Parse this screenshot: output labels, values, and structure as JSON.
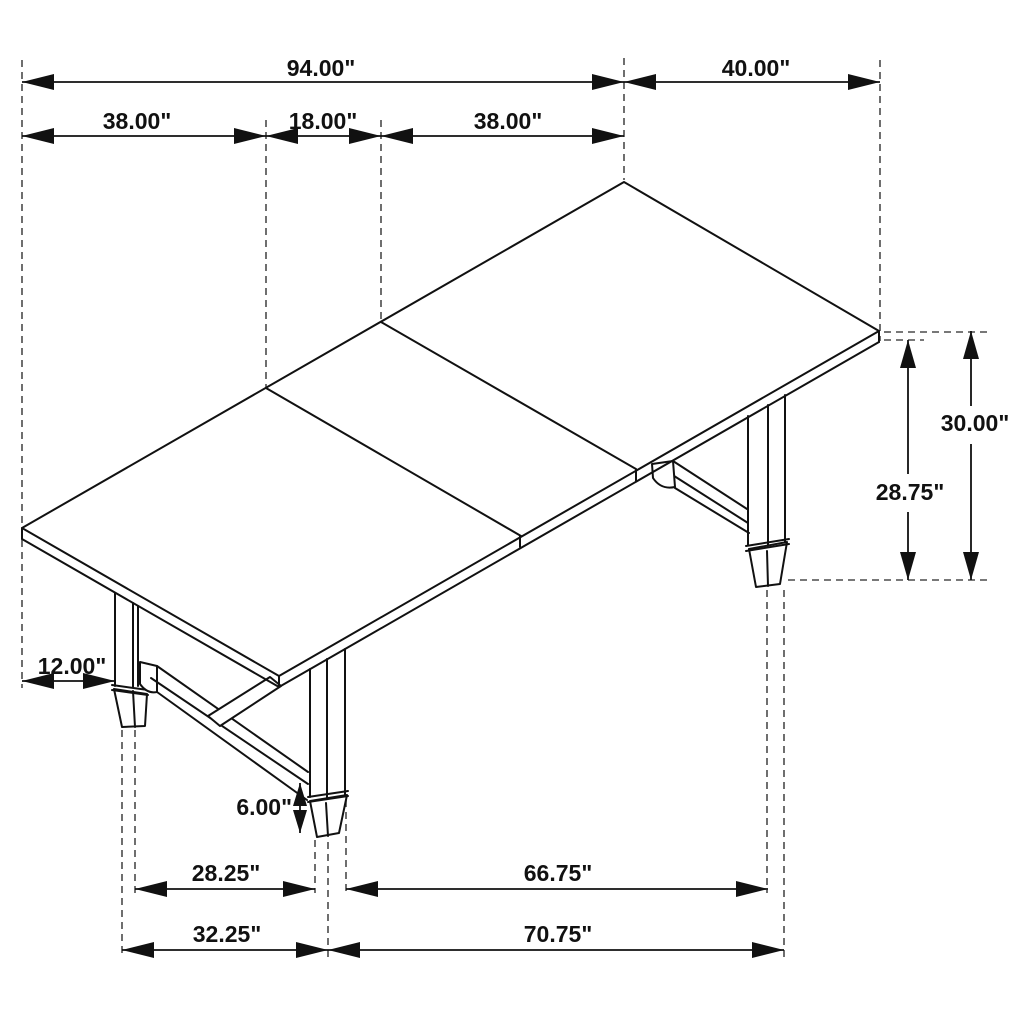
{
  "diagram": {
    "subject": "dining-table-dimension-drawing",
    "unit": "inches",
    "colors": {
      "background": "#ffffff",
      "drawing_line": "#111111",
      "extension_dash": "#4b4b4b",
      "text": "#111111"
    },
    "dims": {
      "overall_length": "94.00\"",
      "table_width": "40.00\"",
      "left_section_length": "38.00\"",
      "leaf_length": "18.00\"",
      "right_section_length": "38.00\"",
      "table_height": "30.00\"",
      "clearance_height": "28.75\"",
      "end_overhang": "12.00\"",
      "foot_height": "6.00\"",
      "feet_inner_spacing": "28.25\"",
      "feet_long_inner_spacing": "66.75\"",
      "feet_outer_spacing": "32.25\"",
      "feet_long_outer_spacing": "70.75\""
    }
  }
}
